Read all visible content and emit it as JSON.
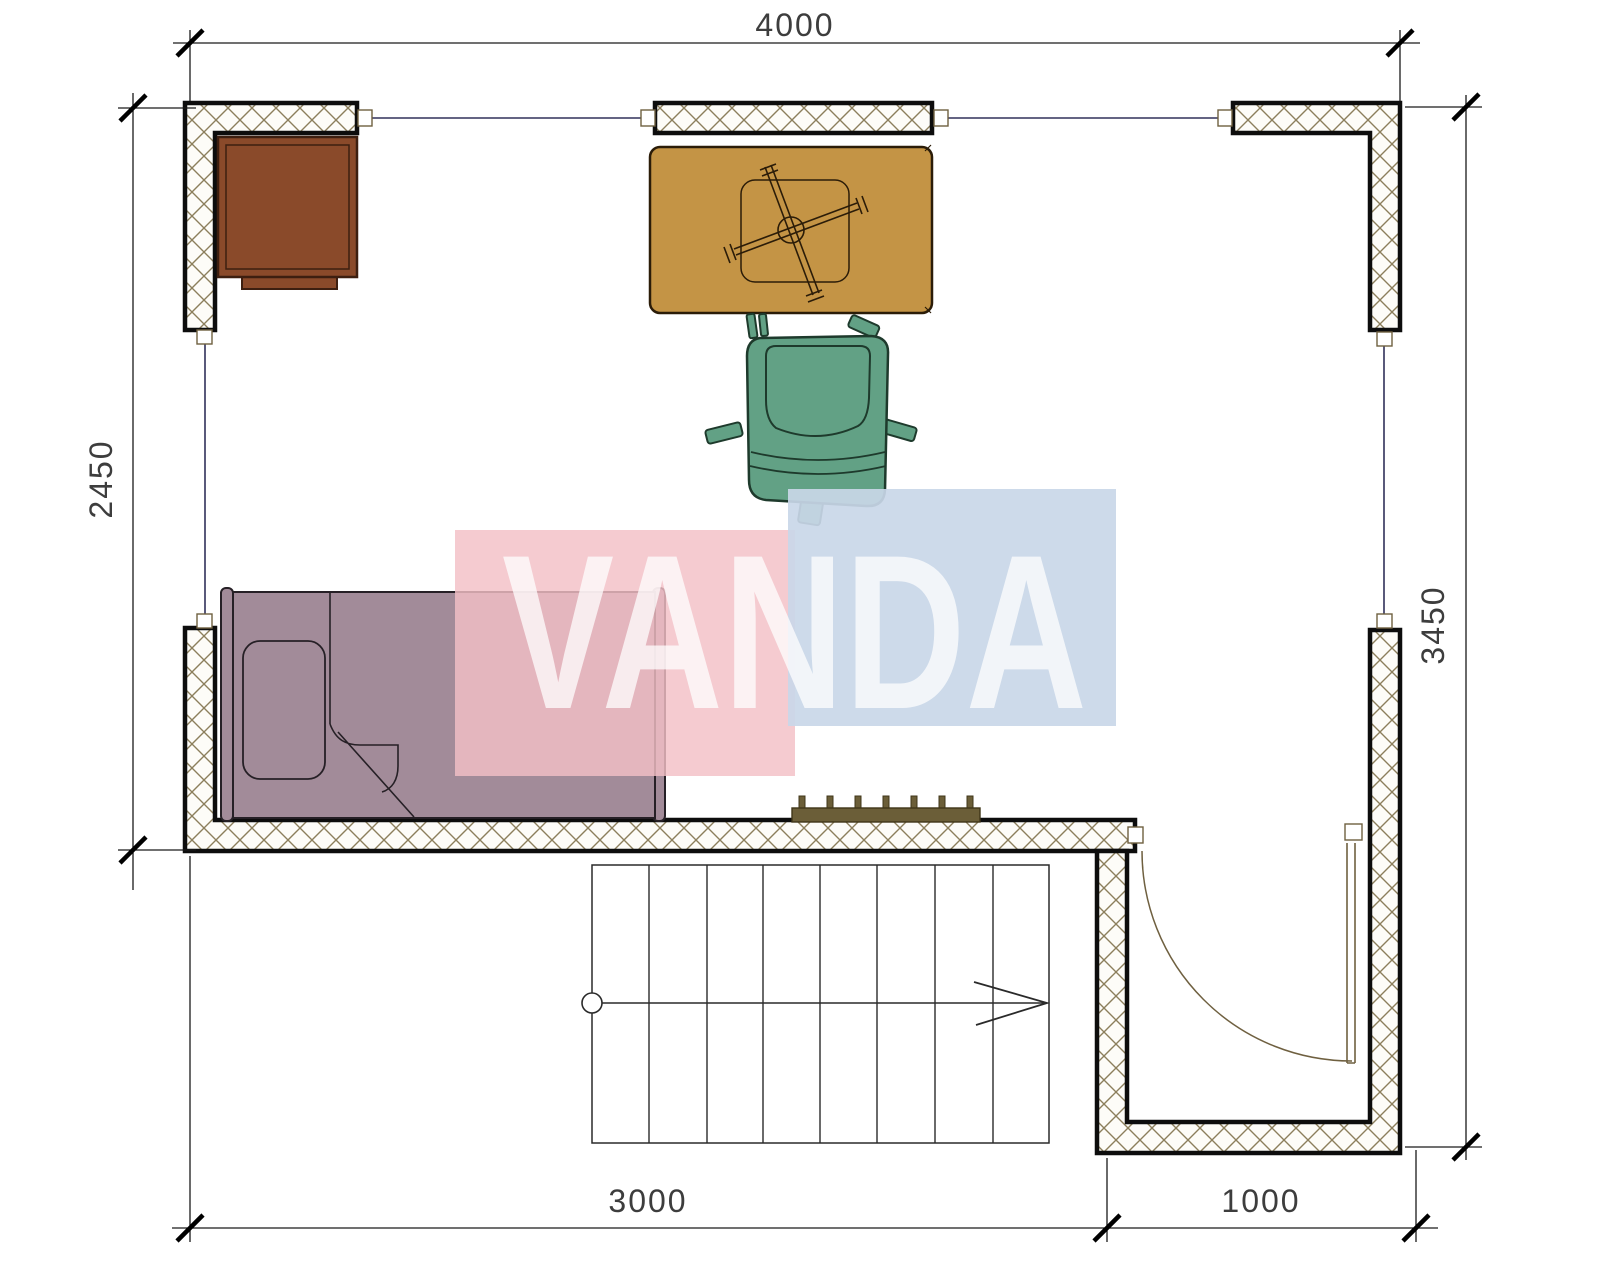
{
  "page": {
    "type": "architectural floor plan with watermark",
    "background": "#ffffff"
  },
  "dimensions": {
    "top": "4000",
    "left": "2450",
    "right": "3450",
    "bottom_left": "3000",
    "bottom_right": "1000"
  },
  "watermark": {
    "text": "VANDA"
  },
  "stairs": {
    "treads": 8
  },
  "colors": {
    "wall_outline": "#0d0d0d",
    "wall_hatch": "#8c7f5c",
    "wall_fill": "#fdfcf8",
    "window_line": "#30305a",
    "frame_olive": "#6f6040",
    "dim_line": "#1a1a1a",
    "dim_text": "#3d3d3d",
    "desk": "#8a4a2a",
    "desk_outline": "#3d1f10",
    "table": "#c49445",
    "table_outline": "#2b1c08",
    "chair": "#62a185",
    "chair_outline": "#1e3a2c",
    "bed": "#a28b99",
    "bed_outline": "#262026",
    "radiator": "#6b5e38",
    "radiator_outline": "#3f3518",
    "door": "#6f6040",
    "watermark_pink": "#f3bfc6",
    "watermark_blue": "#c9d7e8",
    "watermark_text": "#ffffff"
  }
}
